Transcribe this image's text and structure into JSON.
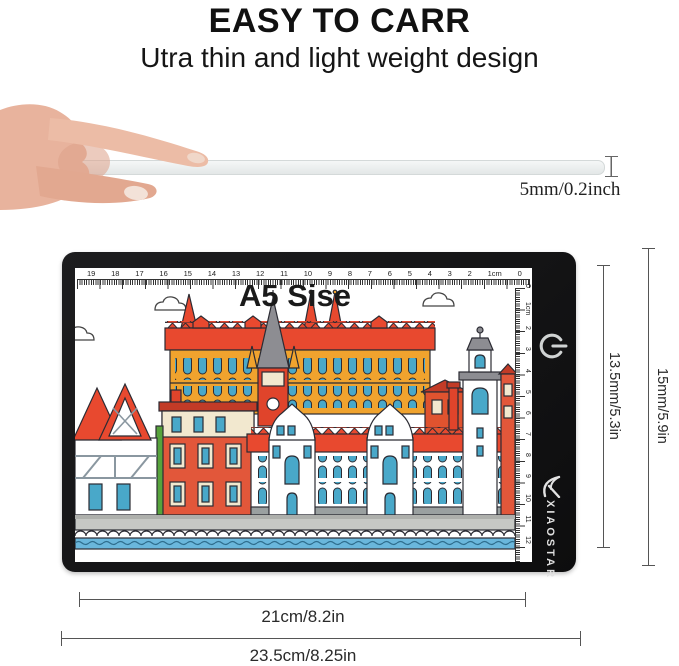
{
  "header": {
    "title": "EASY TO CARR",
    "subtitle": "Utra thin and light weight design"
  },
  "thickness": {
    "label": "5mm/0.2inch"
  },
  "pad": {
    "size_label": "A5 Sise",
    "brand": "XIAOSTAR",
    "ruler_top": [
      "19",
      "18",
      "17",
      "16",
      "15",
      "14",
      "13",
      "12",
      "11",
      "10",
      "9",
      "8",
      "7",
      "6",
      "5",
      "4",
      "3",
      "2",
      "1cm",
      "0"
    ],
    "ruler_side": [
      "0",
      "1cm",
      "2",
      "3",
      "4",
      "5",
      "6",
      "7",
      "8",
      "9",
      "10",
      "11",
      "12"
    ]
  },
  "dimensions": {
    "display_height": "13.5mm/5.3in",
    "total_height": "15mm/5.9in",
    "display_width": "21cm/8.2in",
    "total_width": "23.5cm/8.25in"
  },
  "icons": {
    "power": "power-symbol",
    "brand_mark": "swirl-k",
    "cloud": "outlined-cloud"
  },
  "colors": {
    "pad_black": "#141414",
    "roof_red": "#e8492f",
    "building_yellow": "#f0a32e",
    "window_blue": "#49a8c9",
    "cream": "#f2e8cf",
    "water_blue": "#6ab7dc",
    "quay_gray": "#c6c8c4"
  }
}
